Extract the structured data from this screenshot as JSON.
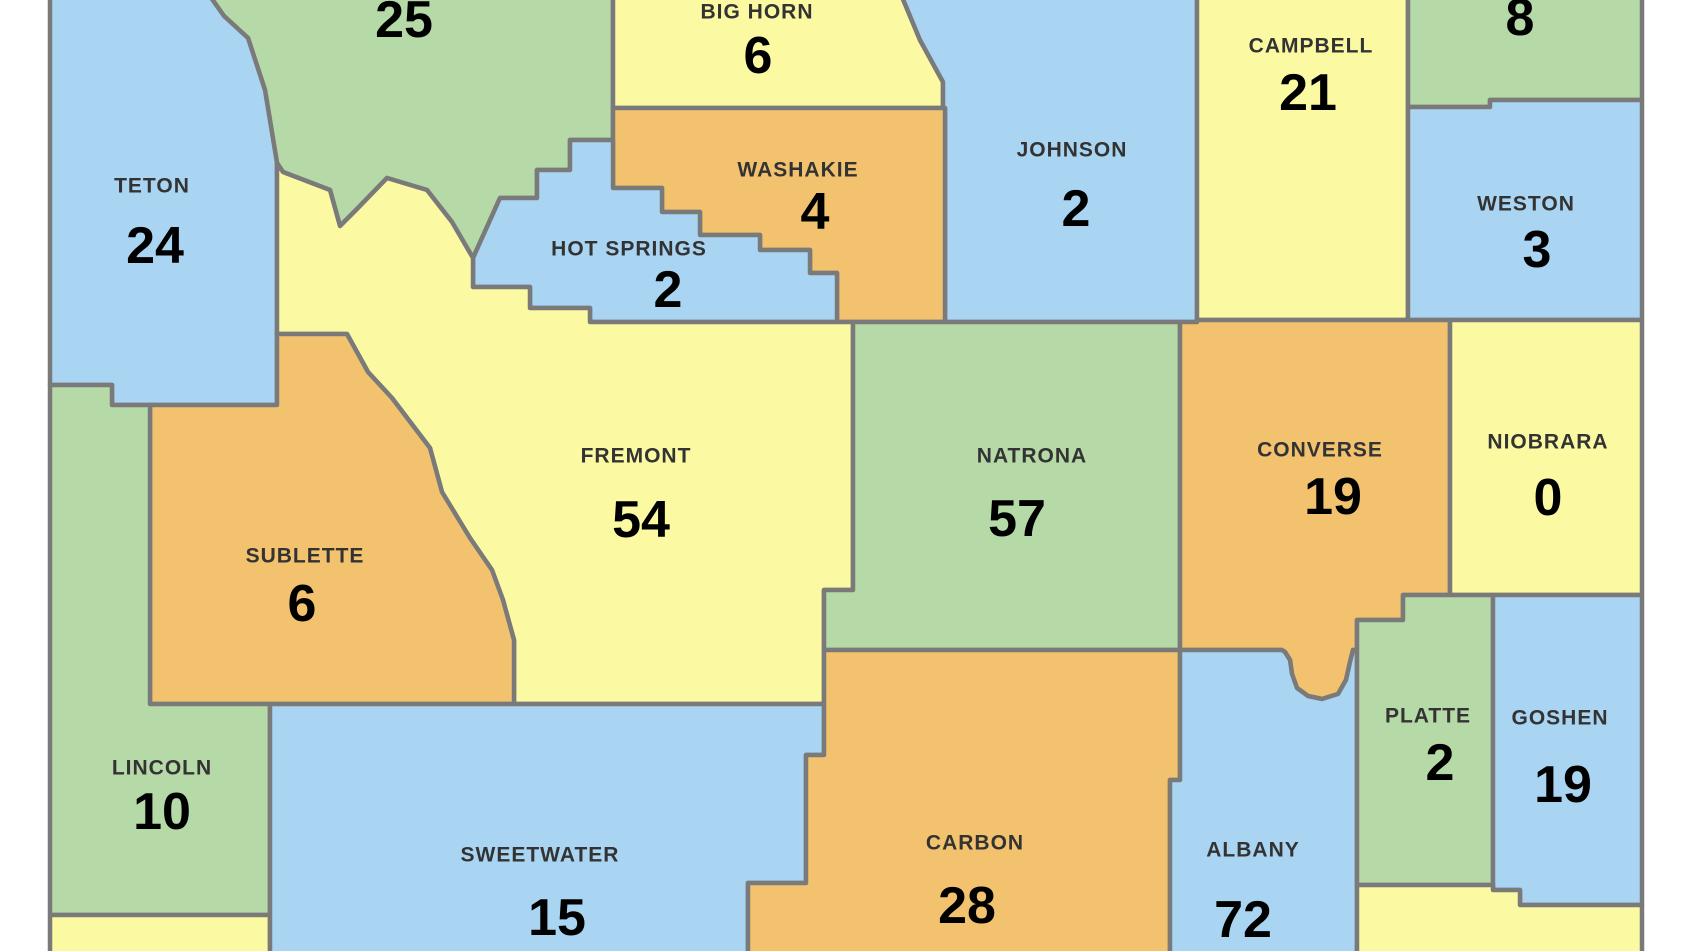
{
  "map": {
    "palette": {
      "blue": "#A9D5F3",
      "green": "#B5D9A7",
      "yellow": "#FBF9A2",
      "orange": "#F2C26E",
      "border": "#7A7A7A",
      "background": "#FFFFFF",
      "name_text": "#333333",
      "value_text": "#000000"
    },
    "counties": {
      "teton": {
        "label": "TETON",
        "value": "24",
        "fill": "#A9D5F3"
      },
      "park": {
        "label": "",
        "value": "25",
        "fill": "#B5D9A7"
      },
      "bighorn": {
        "label": "BIG HORN",
        "value": "6",
        "fill": "#FBF9A2"
      },
      "washakie": {
        "label": "WASHAKIE",
        "value": "4",
        "fill": "#F2C26E"
      },
      "hotsprings": {
        "label": "HOT SPRINGS",
        "value": "2",
        "fill": "#A9D5F3"
      },
      "johnson": {
        "label": "JOHNSON",
        "value": "2",
        "fill": "#A9D5F3"
      },
      "campbell": {
        "label": "CAMPBELL",
        "value": "21",
        "fill": "#FBF9A2"
      },
      "crook": {
        "label": "",
        "value": "8",
        "fill": "#B5D9A7"
      },
      "weston": {
        "label": "WESTON",
        "value": "3",
        "fill": "#A9D5F3"
      },
      "fremont": {
        "label": "FREMONT",
        "value": "54",
        "fill": "#FBF9A2"
      },
      "natrona": {
        "label": "NATRONA",
        "value": "57",
        "fill": "#B5D9A7"
      },
      "converse": {
        "label": "CONVERSE",
        "value": "19",
        "fill": "#F2C26E"
      },
      "niobrara": {
        "label": "NIOBRARA",
        "value": "0",
        "fill": "#FBF9A2"
      },
      "sublette": {
        "label": "SUBLETTE",
        "value": "6",
        "fill": "#F2C26E"
      },
      "lincoln": {
        "label": "LINCOLN",
        "value": "10",
        "fill": "#B5D9A7"
      },
      "sweetwater": {
        "label": "SWEETWATER",
        "value": "15",
        "fill": "#A9D5F3"
      },
      "carbon": {
        "label": "CARBON",
        "value": "28",
        "fill": "#F2C26E"
      },
      "albany": {
        "label": "ALBANY",
        "value": "72",
        "fill": "#A9D5F3"
      },
      "platte": {
        "label": "PLATTE",
        "value": "2",
        "fill": "#B5D9A7"
      },
      "goshen": {
        "label": "GOSHEN",
        "value": "19",
        "fill": "#A9D5F3"
      },
      "uinta": {
        "label": "",
        "value": "",
        "fill": "#FBF9A2"
      },
      "laramie": {
        "label": "",
        "value": "",
        "fill": "#FBF9A2"
      }
    }
  }
}
